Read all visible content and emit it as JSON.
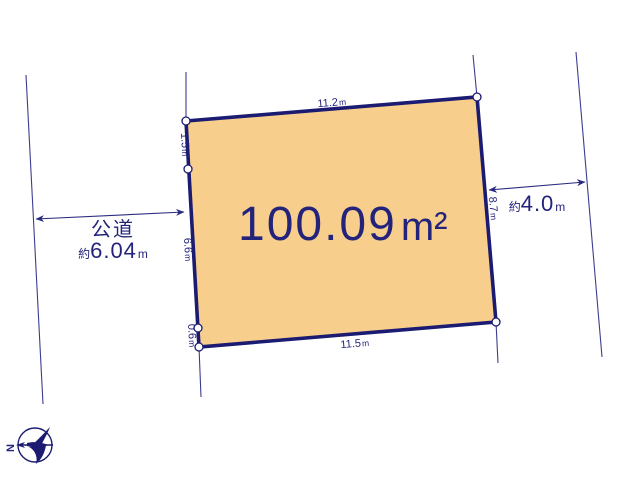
{
  "diagram": {
    "type": "land-plot-survey",
    "colors": {
      "plot_fill": "#F8CE8D",
      "line_navy": "#1B1B72",
      "text_navy": "#23237B",
      "marker_fill": "#FFFFFF"
    },
    "plot": {
      "area_value": "100.09",
      "area_unit": "m²"
    },
    "edges": {
      "top": {
        "value": "11.2",
        "unit": "m"
      },
      "bottom": {
        "value": "11.5",
        "unit": "m"
      },
      "right": {
        "value": "8.7",
        "unit": "m"
      },
      "left_top": {
        "value": "1.5",
        "unit": "m"
      },
      "left_middle": {
        "value": "6.6",
        "unit": "m"
      },
      "left_bottom": {
        "value": "0.6",
        "unit": "m"
      }
    },
    "roads": {
      "left": {
        "name": "公道",
        "approx": "約",
        "value": "6.04",
        "unit": "m"
      },
      "right": {
        "approx": "約",
        "value": "4.0",
        "unit": "m"
      }
    },
    "compass": {
      "label": "N"
    }
  }
}
